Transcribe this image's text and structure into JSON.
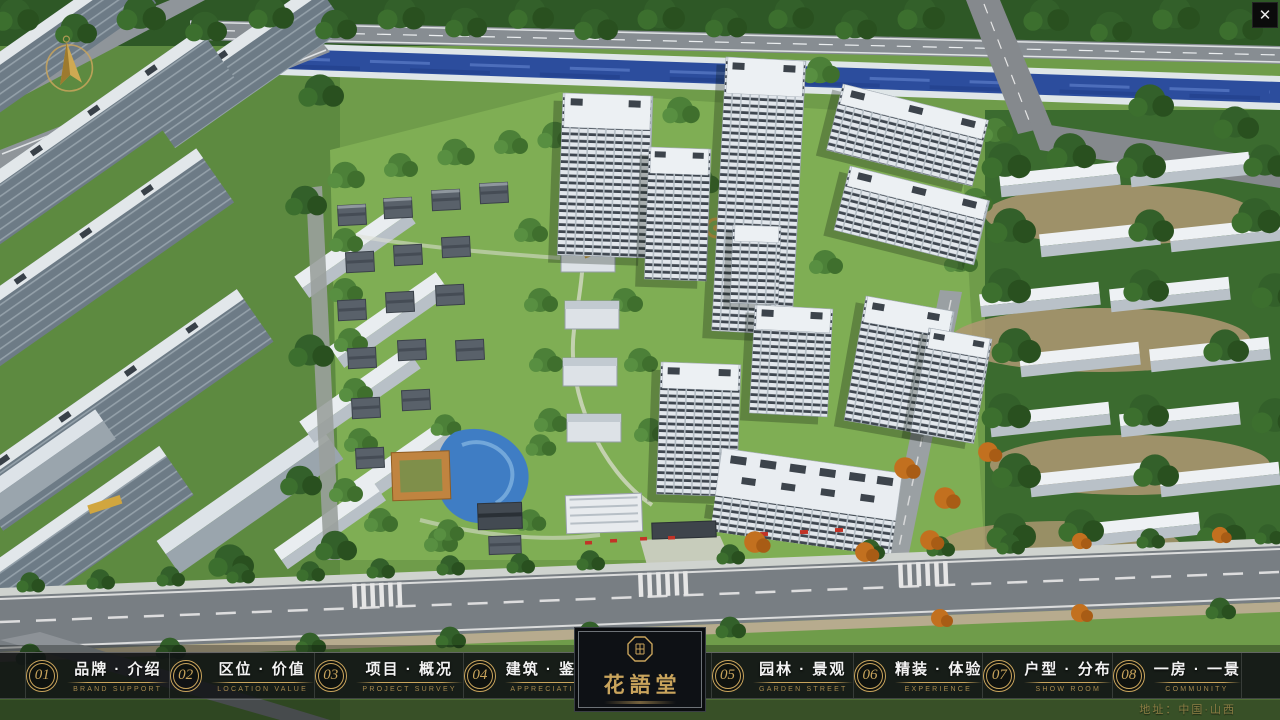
{
  "header": {
    "close": "✕"
  },
  "nav": {
    "items": [
      {
        "num": "01",
        "label": "品牌 · 介绍",
        "sub": "BRAND SUPPORT"
      },
      {
        "num": "02",
        "label": "区位 · 价值",
        "sub": "LOCATION VALUE"
      },
      {
        "num": "03",
        "label": "项目 · 概况",
        "sub": "PROJECT SURVEY"
      },
      {
        "num": "04",
        "label": "建筑 · 鉴赏",
        "sub": "APPRECIATION"
      },
      {
        "num": "05",
        "label": "园林 · 景观",
        "sub": "GARDEN STREET"
      },
      {
        "num": "06",
        "label": "精装 · 体验",
        "sub": "EXPERIENCE"
      },
      {
        "num": "07",
        "label": "户型 · 分布",
        "sub": "SHOW ROOM"
      },
      {
        "num": "08",
        "label": "一房 · 一景",
        "sub": "COMMUNITY"
      }
    ]
  },
  "logo": {
    "title": "花語堂"
  },
  "footer": {
    "address": "地址：中国·山西"
  },
  "colors": {
    "gold": "#c9a45c",
    "bar_bg": "rgba(16,18,20,0.88)",
    "river": "#2c4d9d",
    "grass": "#6f9c4a"
  }
}
